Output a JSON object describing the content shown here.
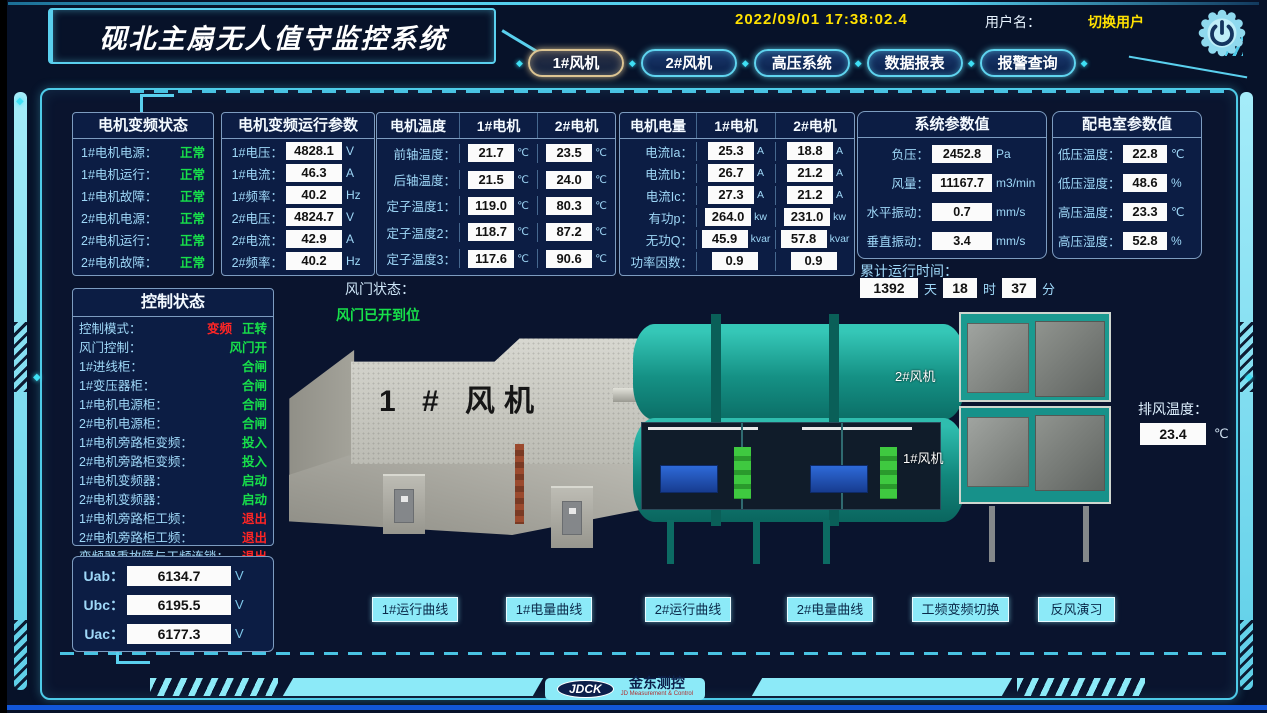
{
  "colors": {
    "accent": "#5ad0ee",
    "green": "#17e04a",
    "red": "#ff2525",
    "yellow": "#ffe100",
    "tab_active_border": "#dcc492",
    "value_box_bg": "#fbfbfb",
    "panel_bg": "#0c1d44"
  },
  "header": {
    "title": "砚北主扇无人值守监控系统",
    "datetime": "2022/09/01  17:38:02.4",
    "user_label": "用户名：",
    "switch_user": "切换用户",
    "power_icon": "power-icon",
    "tabs": [
      {
        "label": "1#风机",
        "active": true
      },
      {
        "label": "2#风机",
        "active": false
      },
      {
        "label": "高压系统",
        "active": false
      },
      {
        "label": "数据报表",
        "active": false
      },
      {
        "label": "报警查询",
        "active": false
      }
    ]
  },
  "vfd_status": {
    "title": "电机变频状态",
    "rows": [
      {
        "label": "1#电机电源：",
        "vals": [
          {
            "t": "正常",
            "c": "g"
          }
        ]
      },
      {
        "label": "1#电机运行：",
        "vals": [
          {
            "t": "正常",
            "c": "g"
          }
        ]
      },
      {
        "label": "1#电机故障：",
        "vals": [
          {
            "t": "正常",
            "c": "g"
          }
        ]
      },
      {
        "label": "2#电机电源：",
        "vals": [
          {
            "t": "正常",
            "c": "g"
          }
        ]
      },
      {
        "label": "2#电机运行：",
        "vals": [
          {
            "t": "正常",
            "c": "g"
          }
        ]
      },
      {
        "label": "2#电机故障：",
        "vals": [
          {
            "t": "正常",
            "c": "g"
          }
        ]
      }
    ]
  },
  "vfd_params": {
    "title": "电机变频运行参数",
    "rows": [
      {
        "label": "1#电压：",
        "v": "4828.1",
        "u": "V"
      },
      {
        "label": "1#电流：",
        "v": "46.3",
        "u": "A"
      },
      {
        "label": "1#频率：",
        "v": "40.2",
        "u": "Hz"
      },
      {
        "label": "2#电压：",
        "v": "4824.7",
        "u": "V"
      },
      {
        "label": "2#电流：",
        "v": "42.9",
        "u": "A"
      },
      {
        "label": "2#频率：",
        "v": "40.2",
        "u": "Hz"
      }
    ]
  },
  "motor_temp": {
    "headers": [
      "电机温度",
      "1#电机",
      "2#电机"
    ],
    "rows": [
      {
        "label": "前轴温度：",
        "v1": "21.7",
        "u1": "℃",
        "v2": "23.5",
        "u2": "℃"
      },
      {
        "label": "后轴温度：",
        "v1": "21.5",
        "u1": "℃",
        "v2": "24.0",
        "u2": "℃"
      },
      {
        "label": "定子温度1：",
        "v1": "119.0",
        "u1": "℃",
        "v2": "80.3",
        "u2": "℃"
      },
      {
        "label": "定子温度2：",
        "v1": "118.7",
        "u1": "℃",
        "v2": "87.2",
        "u2": "℃"
      },
      {
        "label": "定子温度3：",
        "v1": "117.6",
        "u1": "℃",
        "v2": "90.6",
        "u2": "℃"
      }
    ]
  },
  "motor_power": {
    "headers": [
      "电机电量",
      "1#电机",
      "2#电机"
    ],
    "rows": [
      {
        "label": "电流Ia：",
        "v1": "25.3",
        "u1": "A",
        "v2": "18.8",
        "u2": "A"
      },
      {
        "label": "电流Ib：",
        "v1": "26.7",
        "u1": "A",
        "v2": "21.2",
        "u2": "A"
      },
      {
        "label": "电流Ic：",
        "v1": "27.3",
        "u1": "A",
        "v2": "21.2",
        "u2": "A"
      },
      {
        "label": "有功p：",
        "v1": "264.0",
        "u1": "kw",
        "v2": "231.0",
        "u2": "kw"
      },
      {
        "label": "无功Q：",
        "v1": "45.9",
        "u1": "kvar",
        "v2": "57.8",
        "u2": "kvar"
      },
      {
        "label": "功率因数：",
        "v1": "0.9",
        "u1": "",
        "v2": "0.9",
        "u2": ""
      }
    ]
  },
  "system_params": {
    "title": "系统参数值",
    "rows": [
      {
        "label": "负压：",
        "v": "2452.8",
        "u": "Pa"
      },
      {
        "label": "风量：",
        "v": "11167.7",
        "u": "m3/min"
      },
      {
        "label": "水平振动：",
        "v": "0.7",
        "u": "mm/s"
      },
      {
        "label": "垂直振动：",
        "v": "3.4",
        "u": "mm/s"
      }
    ]
  },
  "dist_room": {
    "title": "配电室参数值",
    "rows": [
      {
        "label": "低压温度：",
        "v": "22.8",
        "u": "℃"
      },
      {
        "label": "低压湿度：",
        "v": "48.6",
        "u": "%"
      },
      {
        "label": "高压温度：",
        "v": "23.3",
        "u": "℃"
      },
      {
        "label": "高压湿度：",
        "v": "52.8",
        "u": "%"
      }
    ]
  },
  "runtime": {
    "label": "累计运行时间：",
    "days": "1392",
    "days_unit": "天",
    "hours": "18",
    "hours_unit": "时",
    "minutes": "37",
    "minutes_unit": "分"
  },
  "control_status": {
    "title": "控制状态",
    "rows": [
      {
        "label": "控制模式：",
        "vals": [
          {
            "t": "变频",
            "c": "r"
          },
          {
            "t": "正转",
            "c": "g"
          }
        ]
      },
      {
        "label": "风门控制：",
        "vals": [
          {
            "t": "风门开",
            "c": "g"
          }
        ]
      },
      {
        "label": "1#进线柜：",
        "vals": [
          {
            "t": "合闸",
            "c": "g"
          }
        ]
      },
      {
        "label": "1#变压器柜：",
        "vals": [
          {
            "t": "合闸",
            "c": "g"
          }
        ]
      },
      {
        "label": "1#电机电源柜：",
        "vals": [
          {
            "t": "合闸",
            "c": "g"
          }
        ]
      },
      {
        "label": "2#电机电源柜：",
        "vals": [
          {
            "t": "合闸",
            "c": "g"
          }
        ]
      },
      {
        "label": "1#电机旁路柜变频：",
        "vals": [
          {
            "t": "投入",
            "c": "g"
          }
        ]
      },
      {
        "label": "2#电机旁路柜变频：",
        "vals": [
          {
            "t": "投入",
            "c": "g"
          }
        ]
      },
      {
        "label": "1#电机变频器：",
        "vals": [
          {
            "t": "启动",
            "c": "g"
          }
        ]
      },
      {
        "label": "2#电机变频器：",
        "vals": [
          {
            "t": "启动",
            "c": "g"
          }
        ]
      },
      {
        "label": "1#电机旁路柜工频：",
        "vals": [
          {
            "t": "退出",
            "c": "r"
          }
        ]
      },
      {
        "label": "2#电机旁路柜工频：",
        "vals": [
          {
            "t": "退出",
            "c": "r"
          }
        ]
      },
      {
        "label": "变频器重故障与工频连锁：",
        "vals": [
          {
            "t": "退出",
            "c": "r"
          }
        ]
      }
    ]
  },
  "line_voltage": {
    "rows": [
      {
        "label": "Uab：",
        "v": "6134.7",
        "u": "V"
      },
      {
        "label": "Ubc：",
        "v": "6195.5",
        "u": "V"
      },
      {
        "label": "Uac：",
        "v": "6177.3",
        "u": "V"
      }
    ]
  },
  "damper": {
    "label": "风门状态：",
    "value": "风门已开到位"
  },
  "diagram": {
    "housing_label": "1 # 风机",
    "duct2_label": "2#风机",
    "duct1_label": "1#风机",
    "exhaust_label": "排风温度：",
    "exhaust_value": "23.4",
    "exhaust_unit": "℃"
  },
  "bottom_buttons": [
    "1#运行曲线",
    "1#电量曲线",
    "2#运行曲线",
    "2#电量曲线",
    "工频变频切换",
    "反风演习"
  ],
  "footer": {
    "logo": "JDCK",
    "brand": "金东测控",
    "brand_sub": "JD Measurement & Control"
  }
}
